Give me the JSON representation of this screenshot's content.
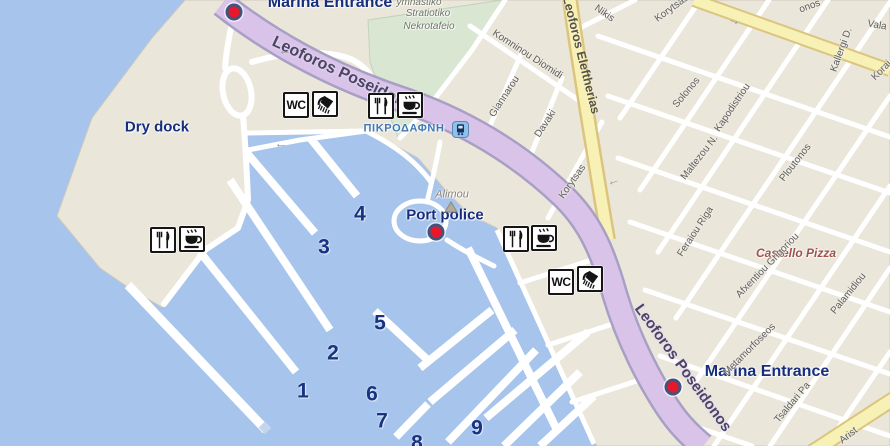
{
  "app": {
    "description": "Alimos marina map with pier numbers, entrances and amenities"
  },
  "colors": {
    "water": "#a6c4ec",
    "land": "#eae6da",
    "park": "#d8e6d2",
    "purple_fill": "#d9c3e9",
    "purple_edge": "#a8a0c4",
    "yellow_fill": "#f8f1b6",
    "yellow_edge": "#dbc57e",
    "navy": "#18337f",
    "red": "#e7182b",
    "marker_ring": "#45527b",
    "street_gray": "#5d5d5d",
    "station_blue": "#8fc1ec"
  },
  "map": {
    "icon_labels": {
      "wc": "WC"
    },
    "markers": [
      {
        "id": "marina-entrance-top",
        "x": 234,
        "y": 12
      },
      {
        "id": "port-police",
        "x": 436,
        "y": 232
      },
      {
        "id": "marina-entrance-bottom",
        "x": 673,
        "y": 387
      }
    ],
    "labels": [
      {
        "id": "marina-entrance-top-label",
        "text": "Marina Entrance",
        "x": 330,
        "y": 3,
        "size": 16,
        "color": "#172e7d",
        "weight": 700
      },
      {
        "id": "dry-dock-label",
        "text": "Dry dock",
        "x": 157,
        "y": 127,
        "size": 15,
        "color": "#172e7d",
        "weight": 700
      },
      {
        "id": "port-police-label",
        "text": "Port police",
        "x": 445,
        "y": 215,
        "size": 15,
        "color": "#172e7d",
        "weight": 700
      },
      {
        "id": "marina-entrance-bottom-label",
        "text": "Marina Entrance",
        "x": 767,
        "y": 372,
        "size": 16,
        "color": "#172e7d",
        "weight": 700
      },
      {
        "id": "alimou-label",
        "text": "Alimou",
        "x": 452,
        "y": 195,
        "size": 11,
        "color": "#8a8377",
        "italic": true
      },
      {
        "id": "pikrodafni-station-label",
        "text": "ΠΙΚΡΟΔΑΦΝΗ",
        "x": 404,
        "y": 129,
        "size": 11,
        "color": "#3e78b7",
        "weight": 700,
        "ls": 0.6
      },
      {
        "id": "cemetery-label-line1",
        "text": "ymnastiko",
        "x": 419,
        "y": 3,
        "size": 10,
        "color": "#6e7366",
        "italic": true
      },
      {
        "id": "cemetery-label-line2",
        "text": "Stratiotiko",
        "x": 428,
        "y": 14,
        "size": 10,
        "color": "#6e7366",
        "italic": true
      },
      {
        "id": "cemetery-label-line3",
        "text": "Nekrotafeio",
        "x": 429,
        "y": 27,
        "size": 10,
        "color": "#6e7366",
        "italic": true
      },
      {
        "id": "castello-pizza-label",
        "text": "Castello Pizza",
        "x": 796,
        "y": 253,
        "size": 12,
        "color": "#a0524a",
        "italic": true,
        "weight": 600
      }
    ],
    "road_labels": [
      {
        "text": "Leoforos Poseidonos",
        "x": 347,
        "y": 76,
        "rotate": 25,
        "size": 16,
        "cls": "purple"
      },
      {
        "text": "Leoforos Poseidonos",
        "x": 683,
        "y": 368,
        "rotate": 54,
        "size": 15,
        "cls": "purple"
      },
      {
        "text": "Leoforos Eleftherias",
        "x": 581,
        "y": 55,
        "rotate": 76,
        "size": 12.5,
        "cls": "yellow"
      }
    ],
    "streets": [
      {
        "name": "Nikis",
        "x": 604,
        "y": 14,
        "rotate": 35
      },
      {
        "name": "Korytsas",
        "x": 672,
        "y": 9,
        "rotate": -36
      },
      {
        "name": "Komninou Diomidi",
        "x": 527,
        "y": 55,
        "rotate": 33
      },
      {
        "name": "Giannarou",
        "x": 505,
        "y": 97,
        "rotate": -57
      },
      {
        "name": "Davaki",
        "x": 546,
        "y": 124,
        "rotate": -57
      },
      {
        "name": "Korytsas",
        "x": 573,
        "y": 182,
        "rotate": -55
      },
      {
        "name": "Solonos",
        "x": 687,
        "y": 93,
        "rotate": -50
      },
      {
        "name": "Kapodistriou",
        "x": 733,
        "y": 108,
        "rotate": -56
      },
      {
        "name": "Maltezou N.",
        "x": 700,
        "y": 158,
        "rotate": -52
      },
      {
        "name": "Ploutonos",
        "x": 796,
        "y": 163,
        "rotate": -52
      },
      {
        "name": "Kallergi D.",
        "x": 842,
        "y": 50,
        "rotate": -70
      },
      {
        "name": "Korai",
        "x": 882,
        "y": 71,
        "rotate": -45
      },
      {
        "name": "Vala",
        "x": 877,
        "y": 26,
        "rotate": 10
      },
      {
        "name": "onos",
        "x": 810,
        "y": 7,
        "rotate": -20
      },
      {
        "name": "Feraiou Riga",
        "x": 696,
        "y": 232,
        "rotate": -57
      },
      {
        "name": "Afxentiou Grigoriou",
        "x": 768,
        "y": 266,
        "rotate": -46
      },
      {
        "name": "Palamidiou",
        "x": 849,
        "y": 294,
        "rotate": -51
      },
      {
        "name": "Metamorfoseos",
        "x": 750,
        "y": 350,
        "rotate": -45
      },
      {
        "name": "Tsaldari Pa",
        "x": 793,
        "y": 403,
        "rotate": -50
      },
      {
        "name": "Arist",
        "x": 849,
        "y": 436,
        "rotate": -38
      }
    ],
    "pier_numbers": [
      {
        "n": "1",
        "x": 303,
        "y": 391
      },
      {
        "n": "2",
        "x": 333,
        "y": 353
      },
      {
        "n": "3",
        "x": 324,
        "y": 247
      },
      {
        "n": "4",
        "x": 360,
        "y": 214
      },
      {
        "n": "5",
        "x": 380,
        "y": 323
      },
      {
        "n": "6",
        "x": 372,
        "y": 394
      },
      {
        "n": "7",
        "x": 382,
        "y": 421
      },
      {
        "n": "8",
        "x": 417,
        "y": 443
      },
      {
        "n": "9",
        "x": 477,
        "y": 428
      }
    ],
    "amenity_icons": [
      {
        "type": "wc",
        "x": 283,
        "y": 92
      },
      {
        "type": "shower",
        "x": 312,
        "y": 91
      },
      {
        "type": "restaurant",
        "x": 368,
        "y": 93
      },
      {
        "type": "cafe",
        "x": 397,
        "y": 92
      },
      {
        "type": "restaurant",
        "x": 150,
        "y": 227
      },
      {
        "type": "cafe",
        "x": 179,
        "y": 226
      },
      {
        "type": "restaurant",
        "x": 503,
        "y": 226
      },
      {
        "type": "cafe",
        "x": 531,
        "y": 225
      },
      {
        "type": "wc",
        "x": 548,
        "y": 269
      },
      {
        "type": "shower",
        "x": 577,
        "y": 266
      },
      {
        "type": "station",
        "x": 452,
        "y": 121
      },
      {
        "type": "monument",
        "x": 444,
        "y": 200
      }
    ],
    "arrows": [
      {
        "x": 281,
        "y": 143,
        "rotate": 0
      },
      {
        "x": 285,
        "y": 50,
        "rotate": 0
      },
      {
        "x": 733,
        "y": 24,
        "rotate": 200
      },
      {
        "x": 613,
        "y": 180,
        "rotate": -20
      }
    ]
  }
}
